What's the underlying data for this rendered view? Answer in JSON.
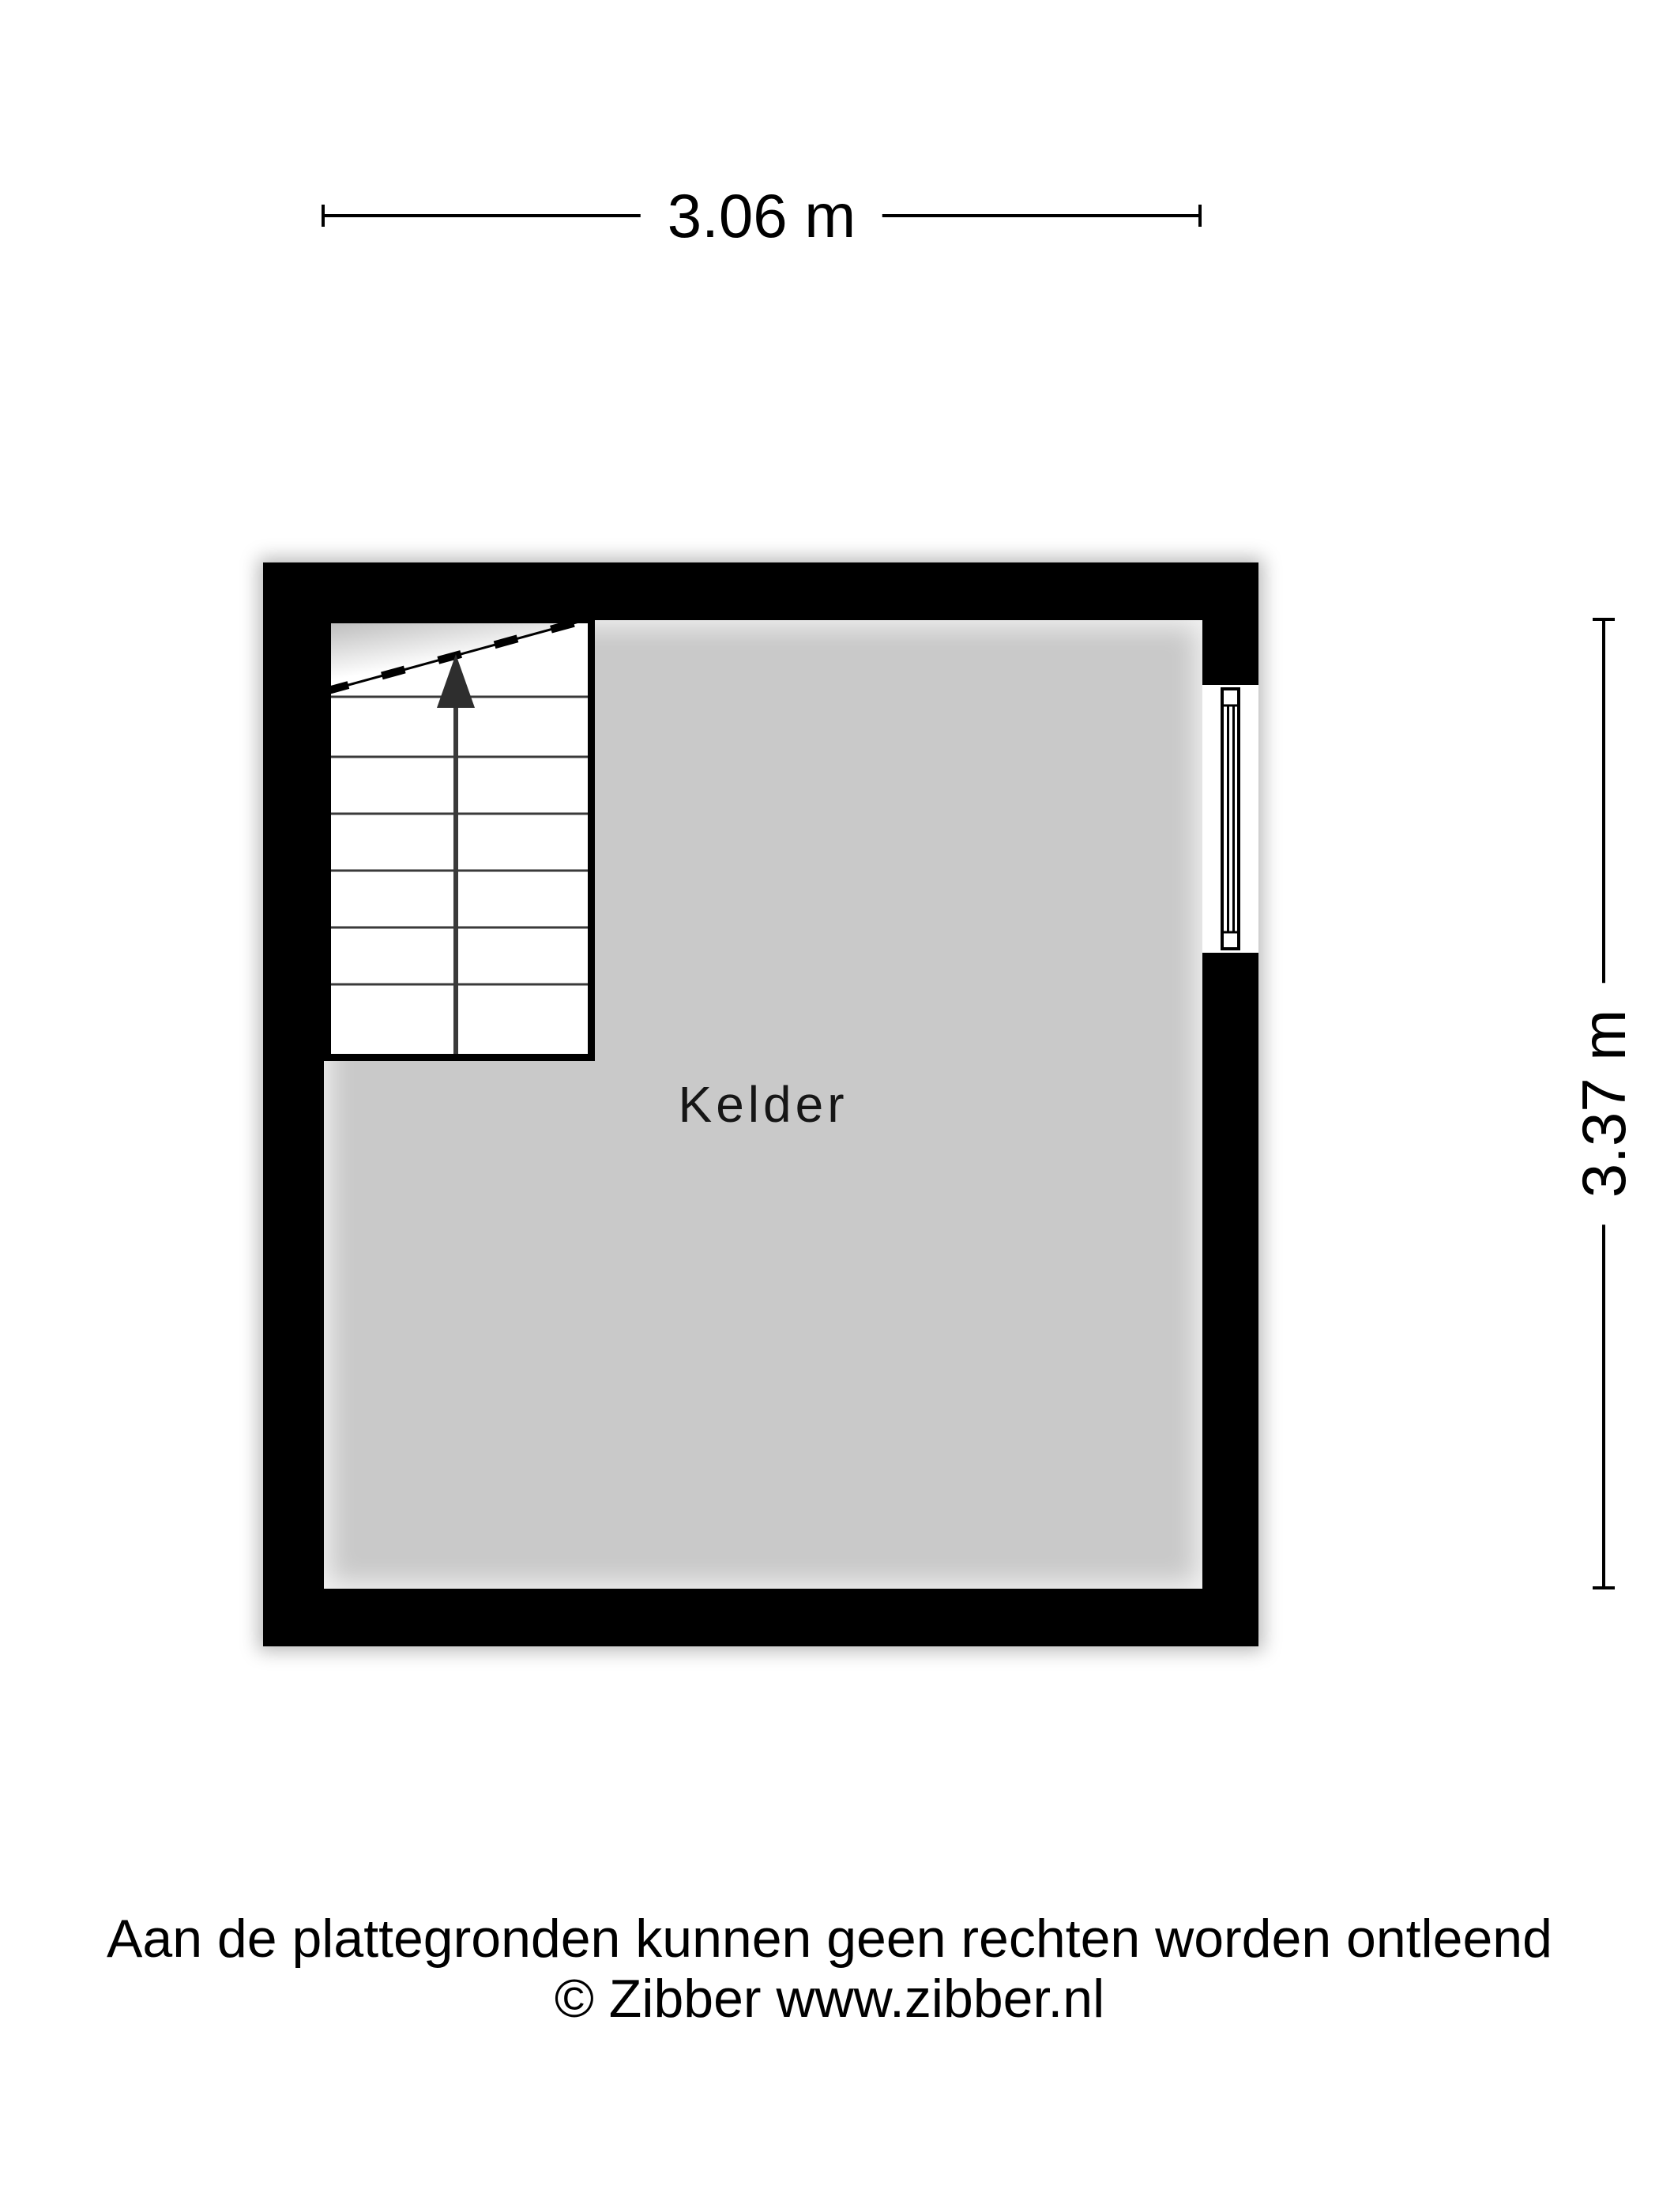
{
  "floorplan": {
    "room": {
      "label": "Kelder"
    },
    "dimensions": {
      "width_label": "3.06 m",
      "height_label": "3.37 m"
    },
    "stairs": {
      "direction": "up"
    },
    "window": {
      "wall": "right"
    },
    "colors": {
      "wall": "#000000",
      "floor": "#c9c9c9",
      "dimension_line": "#000000"
    }
  },
  "footer": {
    "disclaimer": "Aan de plattegronden kunnen geen rechten worden ontleend",
    "copyright": "© Zibber www.zibber.nl"
  }
}
